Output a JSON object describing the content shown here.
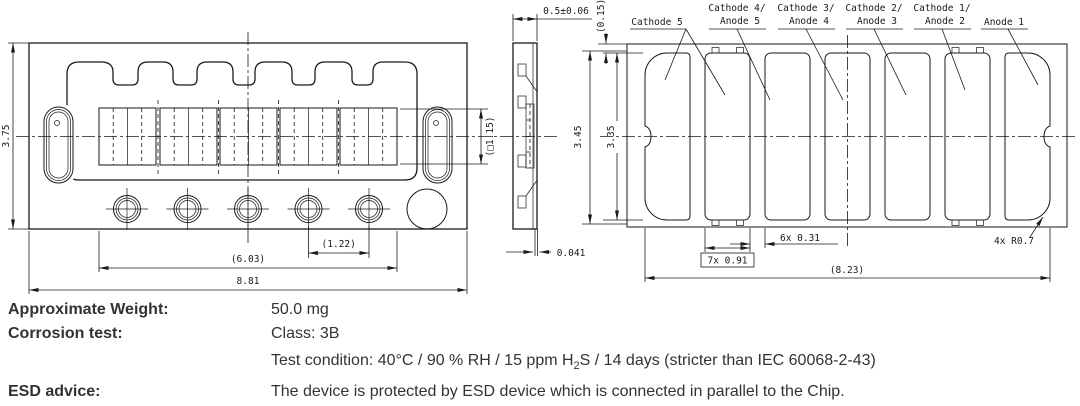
{
  "front_view": {
    "dim_height": "3.75",
    "dim_pitch": "(1.22)",
    "dim_span": "(6.03)",
    "dim_width": "8.81",
    "dim_window": "(□1.15)"
  },
  "side_view": {
    "dim_thickness": "0.5±0.06",
    "dim_lead": "0.041"
  },
  "pad_view": {
    "pin_labels": [
      {
        "line1": "Cathode 5"
      },
      {
        "line1": "Cathode 4/",
        "line2": "Anode 5"
      },
      {
        "line1": "Cathode 3/",
        "line2": "Anode 4"
      },
      {
        "line1": "Cathode 2/",
        "line2": "Anode 3"
      },
      {
        "line1": "Cathode 1/",
        "line2": "Anode 2"
      },
      {
        "line1": "Anode 1"
      }
    ],
    "dim_offset": "(0.15)",
    "dim_height_outer": "3.45",
    "dim_height_pads": "3.35",
    "dim_pad_width": "7x 0.91",
    "dim_pad_gap": "6x 0.31",
    "dim_corner_radius": "4x R0.7",
    "dim_span": "(8.23)"
  },
  "notes": {
    "weight_label": "Approximate Weight:",
    "weight_value": "50.0 mg",
    "corrosion_label": "Corrosion test:",
    "corrosion_class": "Class: 3B",
    "test_condition_pre": "Test condition: 40°C / 90 % RH / 15 ppm H",
    "test_condition_sub": "2",
    "test_condition_post": "S / 14 days (stricter than IEC  60068-2-43)",
    "esd_label": "ESD advice:",
    "esd_text": "The device is protected by ESD device which is connected in parallel to the Chip."
  }
}
